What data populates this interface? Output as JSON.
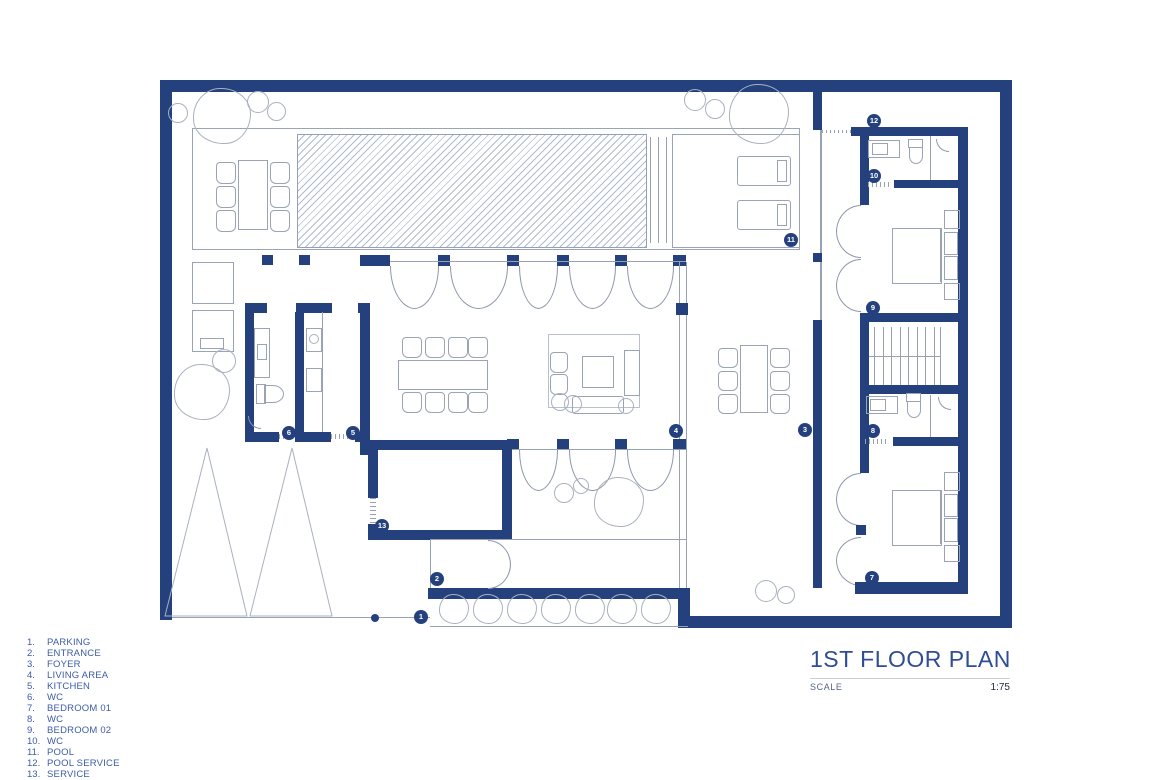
{
  "drawing": {
    "title": "1ST FLOOR PLAN",
    "scale_label": "SCALE",
    "scale_value": "1:75"
  },
  "legend": {
    "items": [
      {
        "num": "1.",
        "label": "PARKING"
      },
      {
        "num": "2.",
        "label": "ENTRANCE"
      },
      {
        "num": "3.",
        "label": "FOYER"
      },
      {
        "num": "4.",
        "label": "LIVING AREA"
      },
      {
        "num": "5.",
        "label": "KITCHEN"
      },
      {
        "num": "6.",
        "label": "WC"
      },
      {
        "num": "7.",
        "label": "BEDROOM 01"
      },
      {
        "num": "8.",
        "label": "WC"
      },
      {
        "num": "9.",
        "label": "BEDROOM 02"
      },
      {
        "num": "10.",
        "label": "WC"
      },
      {
        "num": "11.",
        "label": "POOL"
      },
      {
        "num": "12.",
        "label": "POOL SERVICE"
      },
      {
        "num": "13.",
        "label": "SERVICE"
      }
    ]
  },
  "markers": [
    {
      "n": "1",
      "label": "PARKING",
      "x": 421,
      "y": 617
    },
    {
      "n": "2",
      "label": "ENTRANCE",
      "x": 437,
      "y": 579
    },
    {
      "n": "3",
      "label": "FOYER",
      "x": 805,
      "y": 430
    },
    {
      "n": "4",
      "label": "LIVING AREA",
      "x": 676,
      "y": 431
    },
    {
      "n": "5",
      "label": "KITCHEN",
      "x": 353,
      "y": 433
    },
    {
      "n": "6",
      "label": "WC",
      "x": 289,
      "y": 433
    },
    {
      "n": "7",
      "label": "BEDROOM 01",
      "x": 872,
      "y": 578
    },
    {
      "n": "8",
      "label": "WC",
      "x": 873,
      "y": 431
    },
    {
      "n": "9",
      "label": "BEDROOM 02",
      "x": 873,
      "y": 308
    },
    {
      "n": "10",
      "label": "WC",
      "x": 874,
      "y": 176
    },
    {
      "n": "11",
      "label": "POOL",
      "x": 791,
      "y": 240
    },
    {
      "n": "12",
      "label": "POOL SERVICE",
      "x": 874,
      "y": 121
    },
    {
      "n": "13",
      "label": "SERVICE",
      "x": 382,
      "y": 526
    }
  ],
  "colors": {
    "wall_navy": "#24407d",
    "line_gray": "#98a2b6",
    "legend_text": "#3c5ca6",
    "title_text": "#2e4d94",
    "scale_value_text": "#232a40"
  }
}
